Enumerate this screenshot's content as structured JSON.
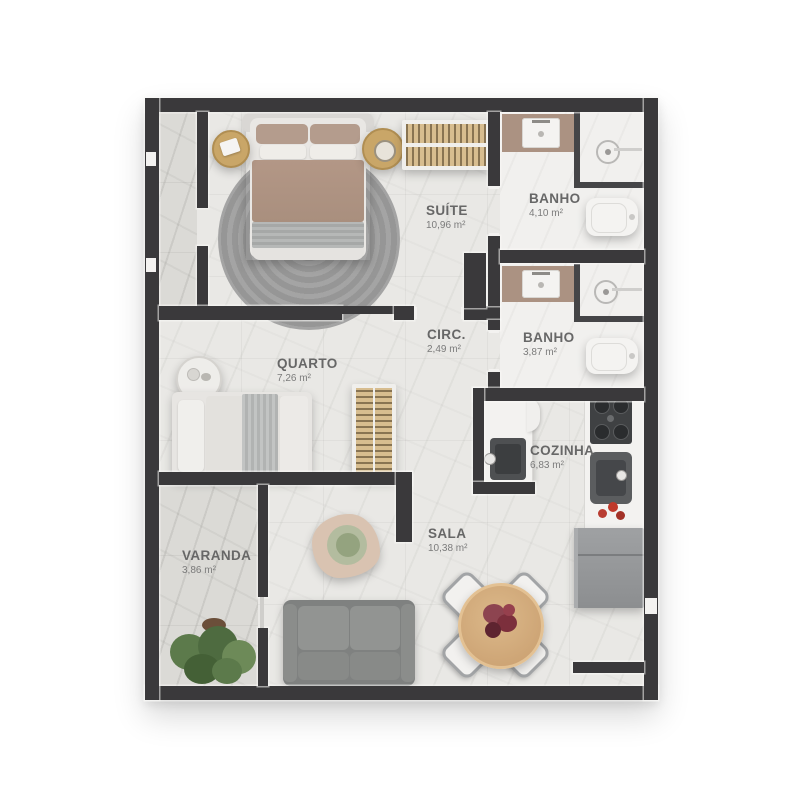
{
  "plan": {
    "type": "apartment-floor-plan",
    "rooms": {
      "suite": {
        "name": "SUÍTE",
        "area": "10,96 m²"
      },
      "banho_suite": {
        "name": "BANHO",
        "area": "4,10 m²"
      },
      "circ": {
        "name": "CIRC.",
        "area": "2,49 m²"
      },
      "banho_social": {
        "name": "BANHO",
        "area": "3,87 m²"
      },
      "quarto": {
        "name": "QUARTO",
        "area": "7,26 m²"
      },
      "cozinha": {
        "name": "COZINHA",
        "area": "6,83 m²"
      },
      "sala": {
        "name": "SALA",
        "area": "10,38 m²"
      },
      "varanda": {
        "name": "VARANDA",
        "area": "3,86 m²"
      }
    },
    "colors": {
      "wall": "#3a393b",
      "floor": "#e9e8e5",
      "floor_dark": "#dbdad6",
      "bath_floor": "#f1f0ee",
      "wood": "#cfa87a",
      "bedding_brown": "#ae9484",
      "sofa_gray": "#85878570",
      "plant_green": "#5c7a4b",
      "flower_red": "#7c2f3c",
      "label_text": "#676767"
    }
  }
}
